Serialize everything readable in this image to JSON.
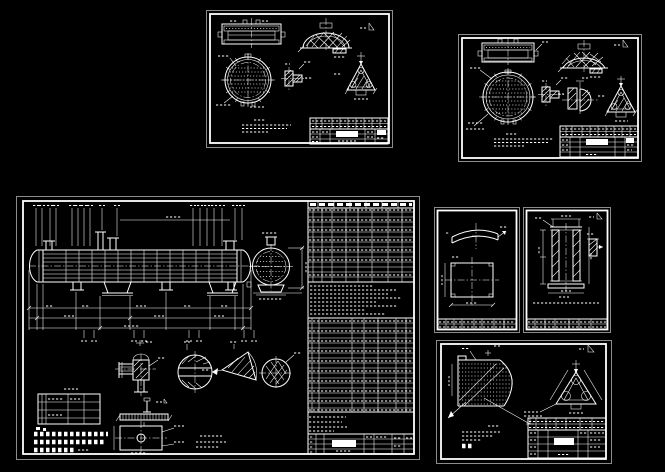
{
  "canvas": {
    "background_color": "#000000",
    "line_color": "#ffffff"
  },
  "sheets": [
    {
      "id": "tube-sheet-drawing-a"
    },
    {
      "id": "tube-sheet-drawing-b"
    },
    {
      "id": "heat-exchanger-assembly-drawing"
    },
    {
      "id": "curved-plate-part-drawing"
    },
    {
      "id": "cylinder-section-part-drawing"
    },
    {
      "id": "tube-layout-sector-drawing"
    }
  ]
}
